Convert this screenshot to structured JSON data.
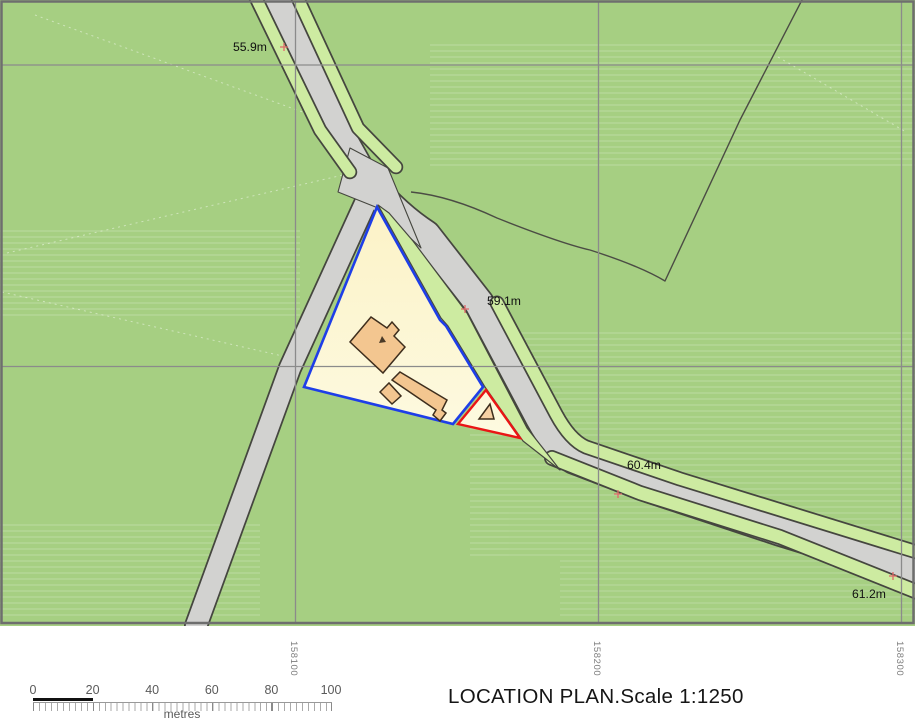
{
  "map": {
    "spot_heights": [
      {
        "label": "55.9m"
      },
      {
        "label": "59.1m"
      },
      {
        "label": "60.4m"
      },
      {
        "label": "61.2m"
      }
    ],
    "grid_labels": [
      "158100",
      "158200",
      "158300"
    ],
    "colors": {
      "field": "#a6cf82",
      "verge": "#cdeba1",
      "road": "#d2d2d0",
      "road_casing": "#45463f",
      "site_fill": "#fdf6d2",
      "building_fill": "#f3c690",
      "site_boundary_blue": "#1e3ee8",
      "outlined_plot_red": "#ea1515",
      "grid_line": "#8b8b8b",
      "survey_cross": "#e06a6a"
    }
  },
  "footer": {
    "title": "LOCATION PLAN.Scale 1:1250",
    "scale_bar": {
      "ticks": [
        "0",
        "20",
        "40",
        "60",
        "80",
        "100"
      ],
      "unit": "metres"
    }
  }
}
